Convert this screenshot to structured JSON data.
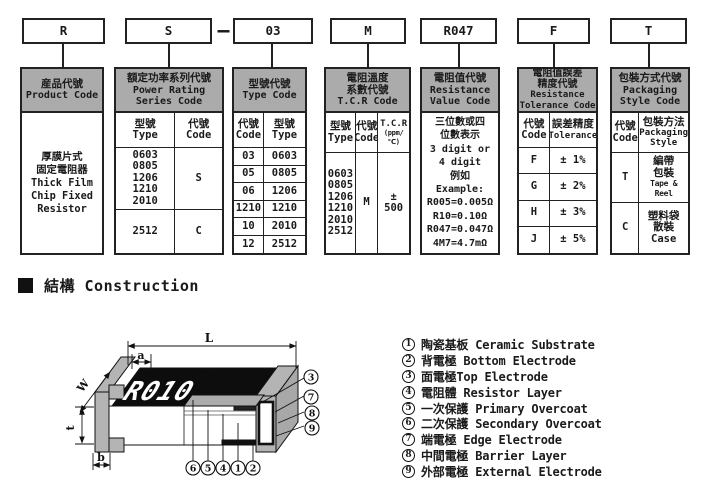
{
  "part_code": {
    "product": "R",
    "series": "S",
    "dash": "—",
    "type": "03",
    "tcr": "M",
    "value": "R047",
    "tolerance": "F",
    "packaging": "T"
  },
  "col_product": {
    "zh": "産品代號",
    "en": "Product Code",
    "body": [
      "厚膜片式",
      "固定電阻器",
      "Thick Film",
      "Chip Fixed",
      "Resistor"
    ]
  },
  "col_series": {
    "zh": "額定功率系列代號",
    "en1": "Power Rating",
    "en2": "Series Code",
    "h_type_zh": "型號",
    "h_type_en": "Type",
    "h_code_zh": "代號",
    "h_code_en": "Code",
    "types": [
      "0603",
      "0805",
      "1206",
      "1210",
      "2010"
    ],
    "code1": "S",
    "type2": "2512",
    "code2": "C"
  },
  "col_type": {
    "zh": "型號代號",
    "en": "Type Code",
    "h_code_zh": "代號",
    "h_code_en": "Code",
    "h_type_zh": "型號",
    "h_type_en": "Type",
    "rows": [
      [
        "03",
        "0603"
      ],
      [
        "05",
        "0805"
      ],
      [
        "06",
        "1206"
      ],
      [
        "1210",
        "1210"
      ],
      [
        "10",
        "2010"
      ],
      [
        "12",
        "2512"
      ]
    ]
  },
  "col_tcr": {
    "zh1": "電阻溫度",
    "zh2": "系數代號",
    "en": "T.C.R Code",
    "h_type_zh": "型號",
    "h_type_en": "Type",
    "h_code_zh": "代號",
    "h_code_en": "Code",
    "h_tcr": "T.C.R",
    "h_ppm": "(ppm/℃)",
    "types": [
      "0603",
      "0805",
      "1206",
      "1210",
      "2010",
      "2512"
    ],
    "code": "M",
    "value": "± 500"
  },
  "col_value": {
    "zh": "電阻值代號",
    "en1": "Resistance",
    "en2": "Value Code",
    "body": [
      "三位數或四",
      "位數表示",
      "3 digit or",
      "4 digit",
      "例如",
      "Example:",
      "R005=0.005Ω",
      "R10=0.10Ω",
      "R047=0.047Ω",
      "4M7=4.7mΩ"
    ]
  },
  "col_tolerance": {
    "zh1": "電阻值誤差",
    "zh2": "精度代號",
    "en1": "Resistance",
    "en2": "Tolerance Code",
    "h_code_zh": "代號",
    "h_code_en": "Code",
    "h_tol_zh": "誤差精度",
    "h_tol_en": "Tolerance",
    "rows": [
      [
        "F",
        "± 1%"
      ],
      [
        "G",
        "± 2%"
      ],
      [
        "H",
        "± 3%"
      ],
      [
        "J",
        "± 5%"
      ]
    ]
  },
  "col_packaging": {
    "zh": "包裝方式代號",
    "en1": "Packaging",
    "en2": "Style Code",
    "h_code_zh": "代號",
    "h_code_en": "Code",
    "h_pkg_zh": "包裝方法",
    "h_pkg_en1": "Packaging",
    "h_pkg_en2": "Style",
    "rows": [
      {
        "code": "T",
        "zh1": "編帶",
        "zh2": "包裝",
        "en": "Tape & Reel"
      },
      {
        "code": "C",
        "zh1": "塑料袋",
        "zh2": "散裝",
        "en": "Case"
      }
    ]
  },
  "construction": {
    "heading": "結構 Construction",
    "marking": "R010",
    "dim_L": "L",
    "dim_a": "a",
    "dim_W": "W",
    "dim_t": "t",
    "dim_b": "b",
    "callouts_right": [
      "3",
      "7",
      "8",
      "9"
    ],
    "callouts_bottom": [
      "6",
      "5",
      "4",
      "1",
      "2"
    ],
    "legend": [
      {
        "num": "1",
        "text": "陶瓷基板 Ceramic Substrate"
      },
      {
        "num": "2",
        "text": "背電極 Bottom Electrode"
      },
      {
        "num": "3",
        "text": "面電極Top Electrode"
      },
      {
        "num": "4",
        "text": "電阻體 Resistor Layer"
      },
      {
        "num": "5",
        "text": "一次保護 Primary Overcoat"
      },
      {
        "num": "6",
        "text": "二次保護 Secondary Overcoat"
      },
      {
        "num": "7",
        "text": "端電極 Edge Electrode"
      },
      {
        "num": "8",
        "text": "中間電極 Barrier Layer"
      },
      {
        "num": "9",
        "text": "外部電極 External Electrode"
      }
    ]
  }
}
